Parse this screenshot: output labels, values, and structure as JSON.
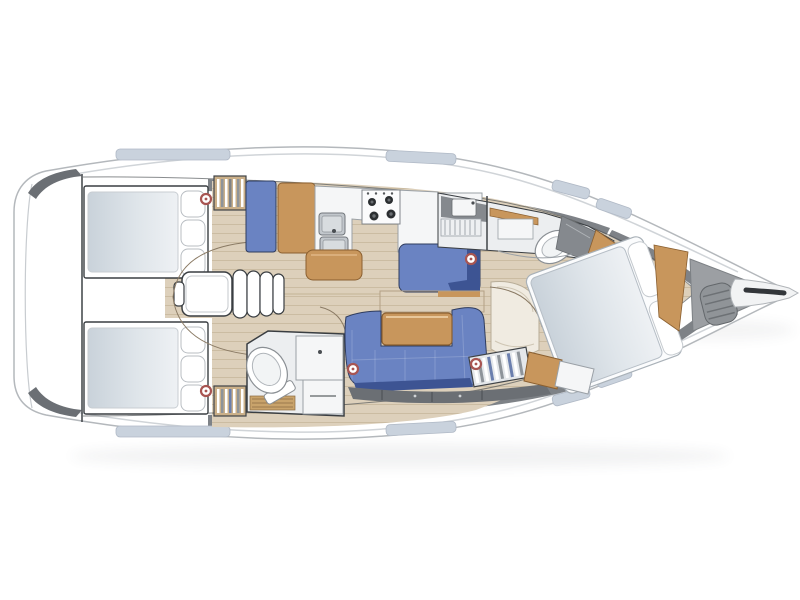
{
  "meta": {
    "description": "Top-down interior floor plan of a sailing yacht, bow pointing right: swim platform astern, twin aft double cabins with pillows and hanging lockers, central engine box and companionway steps, L-shaped galley with twin stainless sinks and four-burner stove, aft heads with toilet and vanity, C-shaped blue saloon settee with wooden table, blue chaise longue, forward heads with shower and toilet, forward owner's cabin with angled island double berth, anchor locker with windlass and a bowsprit at the bow tip."
  },
  "palette": {
    "hull_white": "#ffffff",
    "outline": "#3f4347",
    "floor_wood": "#ddd0bb",
    "plank_line": "#b9a78a",
    "teak_wood": "#c8965c",
    "teak_dark": "#8a5f30",
    "upholstery_blue": "#6a83c2",
    "upholstery_navy": "#3d5493",
    "deck_gray": "#7e8287",
    "band_dark": "#6b6f74",
    "locker_gray": "#9c9fa3",
    "counter_white": "#f5f6f7",
    "steel_gray": "#c2c7cc",
    "window_blue": "#c9d2dd",
    "marker_red": "#a85552",
    "head_floor": "#eceef0",
    "wall_gray": "#85898e",
    "hull_line": "#d0d4d8",
    "door_arc": "#8a7a64",
    "mattress_mid": "#c9d2da",
    "mattress_light": "#eef1f4"
  },
  "features": {
    "rooms": [
      "swim-platform",
      "aft-cabin-port",
      "aft-cabin-starboard",
      "engine-compartment",
      "companionway-steps",
      "galley",
      "aft-head",
      "saloon-settee",
      "saloon-table",
      "chaise-longue",
      "forward-head",
      "forward-cabin",
      "anchor-locker",
      "bowsprit"
    ],
    "stove_burners": 4,
    "sinks_galley": 2,
    "aft_pillows_per_bed": 3,
    "forward_bed_pillows": 2,
    "speaker_marker_count": 5
  }
}
